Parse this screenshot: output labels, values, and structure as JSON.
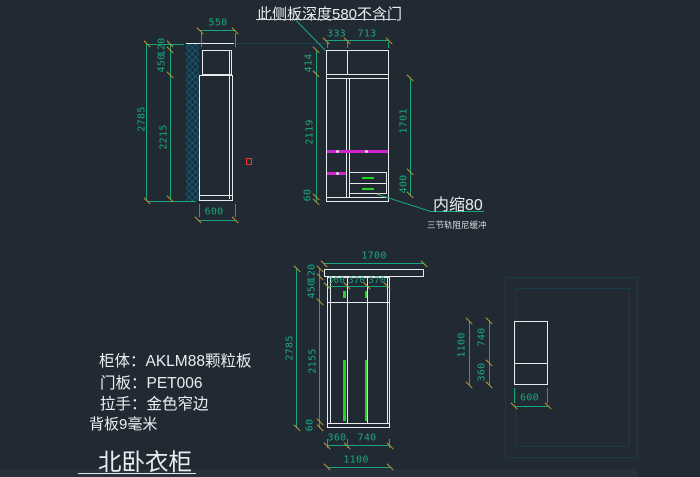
{
  "annotations": {
    "top_note": "此侧板深度580不含门",
    "inset_note": "内缩80",
    "rail_note": "三节轨阻尼缓冲"
  },
  "specs": {
    "body": "柜体：AKLM88颗粒板",
    "door": "门板：PET006",
    "handle": "拉手：金色窄边",
    "back": "背板9毫米",
    "title": "北卧衣柜"
  },
  "dims": {
    "sv1_top_w": "550",
    "sv1_gap": "120",
    "sv1_upper": "450",
    "sv1_total": "2785",
    "sv1_main": "2215",
    "sv1_bottom_w": "600",
    "fv1_w1": "333",
    "fv1_w2": "713",
    "fv1_top": "414",
    "fv1_mid": "2119",
    "fv1_base": "60",
    "fv1_hang": "1701",
    "fv1_drawer": "400",
    "fv2_board": "1700",
    "fv2_d1": "360",
    "fv2_d2": "370",
    "fv2_d3": "370",
    "fv2_gap": "120",
    "fv2_upper": "450",
    "fv2_total": "2785",
    "fv2_mid": "2155",
    "fv2_base": "60",
    "fv2_b1": "360",
    "fv2_b2": "740",
    "fv2_b3": "1100",
    "sv2_total": "1100",
    "sv2_top": "740",
    "sv2_bottom": "360",
    "sv2_depth": "600"
  },
  "colors": {
    "background": "#212a33",
    "dimension_green": "#1aa67d",
    "arrow_tick_gold": "#bf9c30",
    "outline_white": "#e7ebee",
    "hanging_rod_magenta": "#d024d0",
    "handle_green": "#23d423",
    "hatch_teal": "#1b586e",
    "selection_red": "#f3392c",
    "viewport_teal": "#123e4a",
    "text_white": "#e9edf1"
  }
}
